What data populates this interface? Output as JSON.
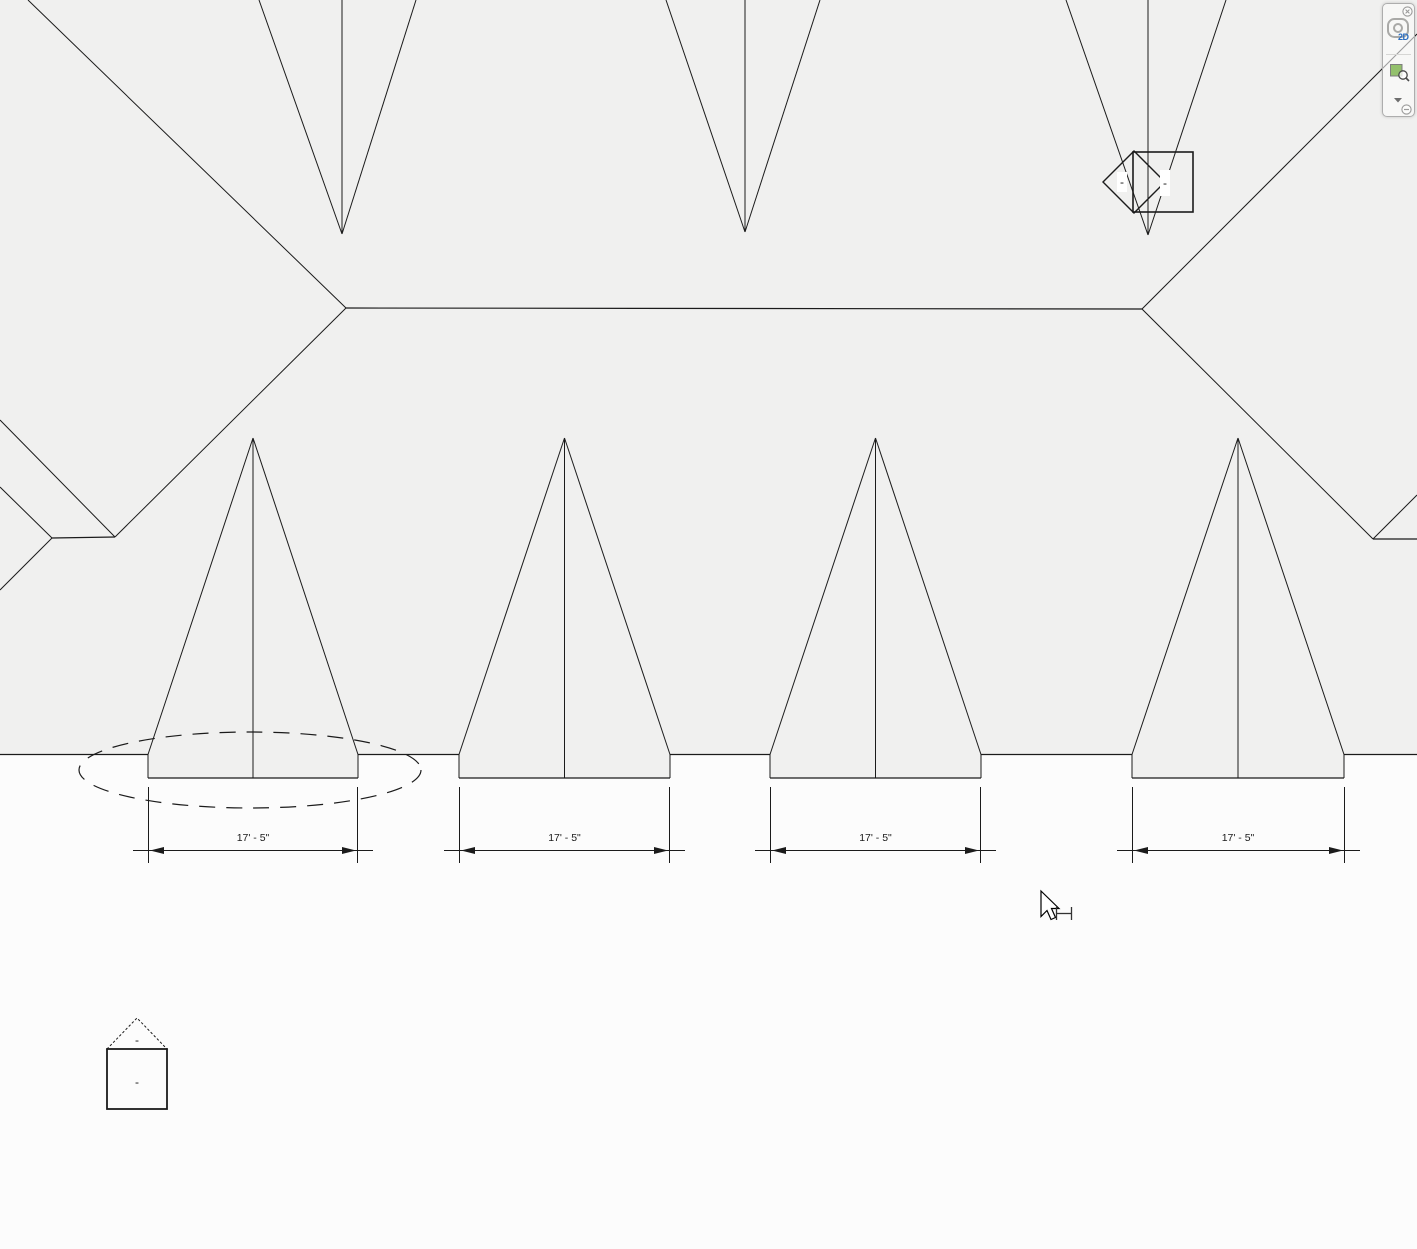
{
  "drawing": {
    "dimensions": [
      {
        "label": "17' - 5\""
      },
      {
        "label": "17' - 5\""
      },
      {
        "label": "17' - 5\""
      },
      {
        "label": "17' - 5\""
      }
    ],
    "callout_marker": {
      "diamond_label": "-",
      "box_label": "-"
    },
    "house_marker": {
      "roof_label": "-",
      "body_label": "-"
    }
  },
  "navigation_bar": {
    "wheel_badge": "2D",
    "icons": [
      "close-icon",
      "steering-wheel-icon",
      "zoom-region-icon",
      "dropdown-arrow-icon",
      "collapse-icon"
    ]
  },
  "cursor": {
    "icons": [
      "arrow-pointer-icon",
      "dimension-tool-badge-icon"
    ]
  },
  "colors": {
    "canvas_background": "#f0f0ef",
    "below_eave_background": "#fcfcfc",
    "line": "#1b1b1b",
    "nav_green": "#93c06c",
    "nav_blue": "#2a6dc0"
  }
}
